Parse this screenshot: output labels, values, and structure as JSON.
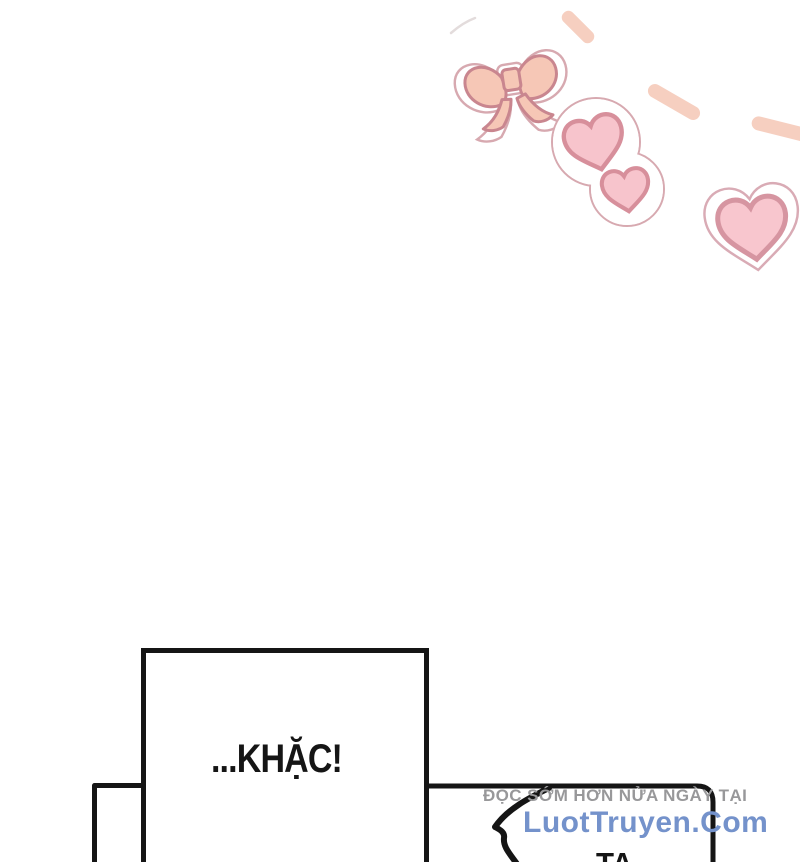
{
  "page": {
    "width": 800,
    "height": 862,
    "background": "#ffffff",
    "kind": "comic-page"
  },
  "decor": {
    "bow_icon": "pink-ribbon-bow-sticker",
    "double_heart_icon": "two-hearts-sticker",
    "big_heart_icon": "large-heart-sticker",
    "dash_trail_icon": "dashed-arc-trail",
    "colors": {
      "ink": "#151515",
      "bow_fill": "#f6c7b6",
      "bow_stroke": "#c9868f",
      "heart_fill": "#f7c4cc",
      "heart_stroke": "#d78f9b",
      "big_heart_fill": "#f8c6ce",
      "big_heart_stroke": "#d695a1",
      "sticker_edge": "#d7a9b0",
      "dash": "#f6cfc0",
      "watermark_gray": "#98989a",
      "watermark_blue": "#7492cb",
      "page_bg": "#ffffff"
    }
  },
  "panel": {
    "sfx_text": "...KHẶC!"
  },
  "bubble": {
    "text": "TA"
  },
  "watermark": {
    "tagline": "ĐỌC SỚM HƠN NỬA NGÀY TẠI",
    "site": "LuotTruyen.Com"
  }
}
